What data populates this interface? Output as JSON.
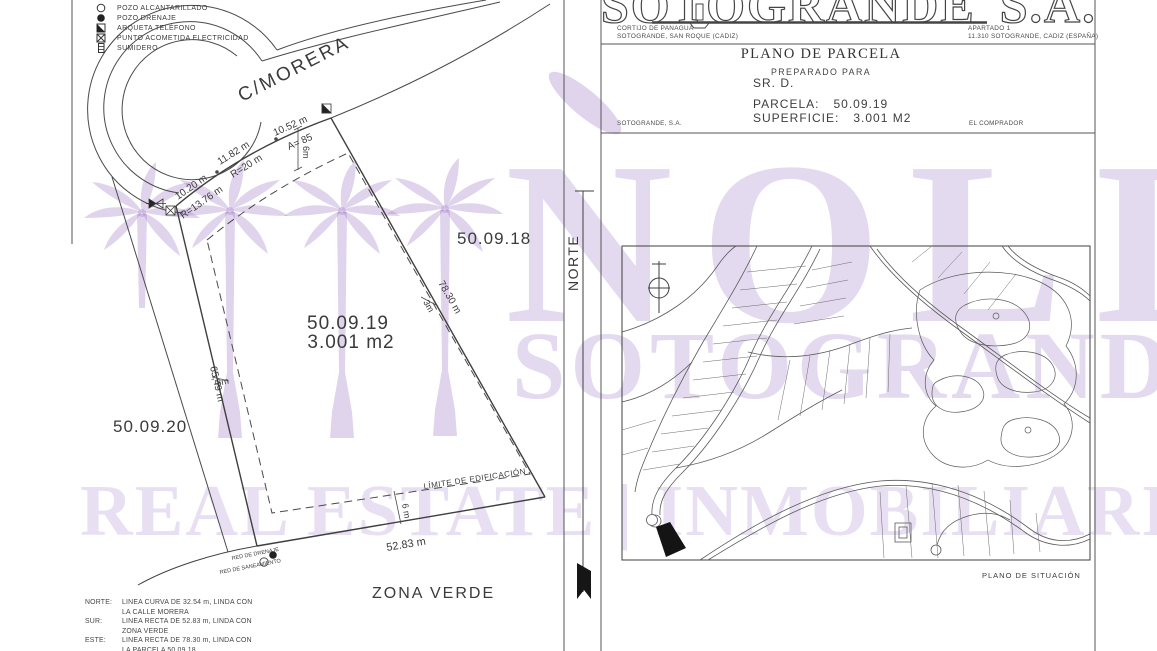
{
  "watermark": {
    "brand": "NOLI",
    "brand_sub": "SOTOGRANDE",
    "banner": "REAL ESTATE | INMOBILIARIA",
    "color": "#9771c2"
  },
  "legend": {
    "items": [
      {
        "icon": "circle-outline-icon",
        "label": "POZO ALCANTARILLADO"
      },
      {
        "icon": "circle-filled-icon",
        "label": "POZO DRENAJE"
      },
      {
        "icon": "square-half-filled-icon",
        "label": "ARQUETA TELÉFONO"
      },
      {
        "icon": "square-x-icon",
        "label": "PUNTO ACOMETIDA ELECTRICIDAD"
      },
      {
        "icon": "grate-icon",
        "label": "SUMIDERO"
      }
    ]
  },
  "plan": {
    "street": "C/MORERA",
    "parcel_id": "50.09.19",
    "parcel_area": "3.001 m2",
    "neighbor_east": "50.09.18",
    "neighbor_west": "50.09.20",
    "green_zone": "ZONA VERDE",
    "building_limit": "LÍMITE DE EDIFICACIÓN",
    "north_label": "NORTE",
    "dims": {
      "north_seg1": "10.52 m",
      "north_seg1_note": "A= 85",
      "north_seg2": "11.82 m",
      "north_seg2_note": "R=20 m",
      "north_seg3": "10.20 m",
      "north_seg3_note": "R=13.76 m",
      "road_setback": "6m",
      "east_length": "78.30 m",
      "east_setback": "3m",
      "west_length": "65,49 m",
      "west_setback": "3m",
      "south_length": "52.83 m",
      "south_setback": "6 m"
    },
    "utilities": {
      "drain": "RED DE DRENAJE",
      "sewer": "RED DE SANEAMIENTO"
    }
  },
  "header": {
    "company": "SOTOGRANDE",
    "company_suffix": "S.A.",
    "address_left1": "CORTIJO DE PANAGUA",
    "address_left2": "SOTOGRANDE, SAN ROQUE (CADIZ)",
    "address_right1": "APARTADO 1",
    "address_right2": "11.310 SOTOGRANDE, CADIZ (ESPAÑA)",
    "title": "PLANO DE PARCELA",
    "subtitle": "PREPARADO PARA",
    "client": "SR. D.",
    "parcel_label": "PARCELA:",
    "parcel_value": "50.09.19",
    "area_label": "SUPERFICIE:",
    "area_value": "3.001 M2",
    "sig_left": "SOTOGRANDE, S.A.",
    "sig_right": "EL COMPRADOR"
  },
  "map": {
    "caption": "PLANO DE SITUACIÓN"
  },
  "notes": {
    "rows": [
      {
        "label": "NORTE:",
        "line1": "LINEA CURVA DE 32.54 m, LINDA CON",
        "line2": "LA CALLE MORERA"
      },
      {
        "label": "SUR:",
        "line1": "LINEA RECTA DE 52.83 m, LINDA CON",
        "line2": "ZONA VERDE"
      },
      {
        "label": "ESTE:",
        "line1": "LINEA RECTA DE 78.30 m, LINDA CON",
        "line2": "LA PARCELA 50.09.18"
      }
    ]
  }
}
